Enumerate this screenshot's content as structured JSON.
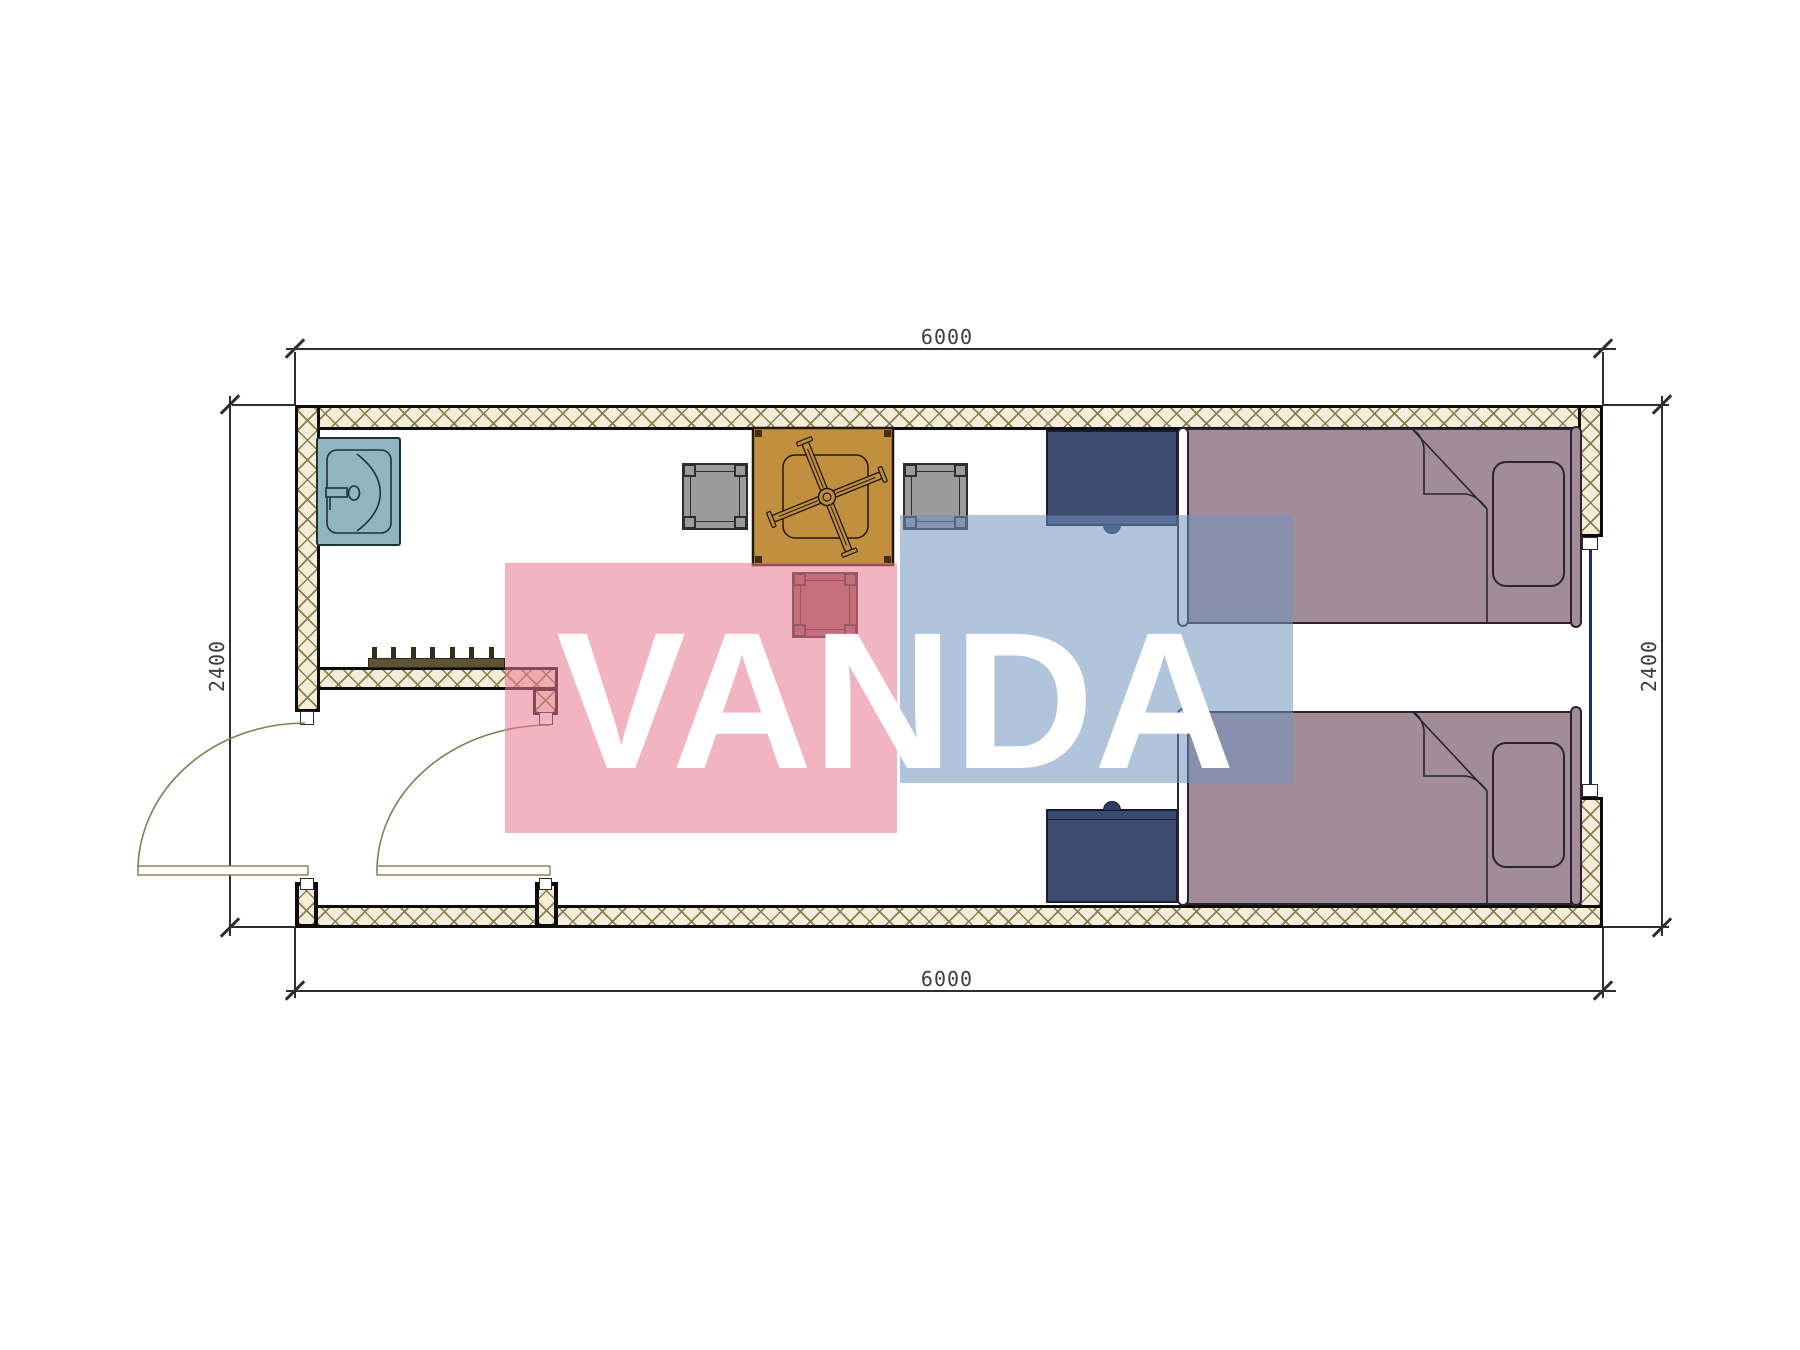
{
  "watermark": {
    "text": "VANDA"
  },
  "dimensions": {
    "width_top": "6000",
    "width_bottom": "6000",
    "height_left": "2400",
    "height_right": "2400"
  },
  "colors": {
    "wall-line": "#0d0d0d",
    "hatch-bg": "#f3edda",
    "hatch-line": "#8d7d4e",
    "dim-line": "#2e2e2e",
    "dim-text": "#3d3d3d",
    "sink": "#8fb6bf",
    "sink-line": "#1f3138",
    "table": "#c0903e",
    "table-line": "#241607",
    "stool": "#9b9b9b",
    "stool-red": "#9d6165",
    "cabinet": "#3d4b70",
    "cabinet-line": "#141c38",
    "bed": "#a28c98",
    "bed-line": "#2a2330",
    "bed-board": "#fdfdfd",
    "door": "#8a7a50",
    "window": "#1b2a6b",
    "rack": "#5c5434",
    "wm-pink": "rgba(232,122,144,0.56)",
    "wm-blue": "rgba(111,148,189,0.55)",
    "wm-text": "#ffffff"
  }
}
